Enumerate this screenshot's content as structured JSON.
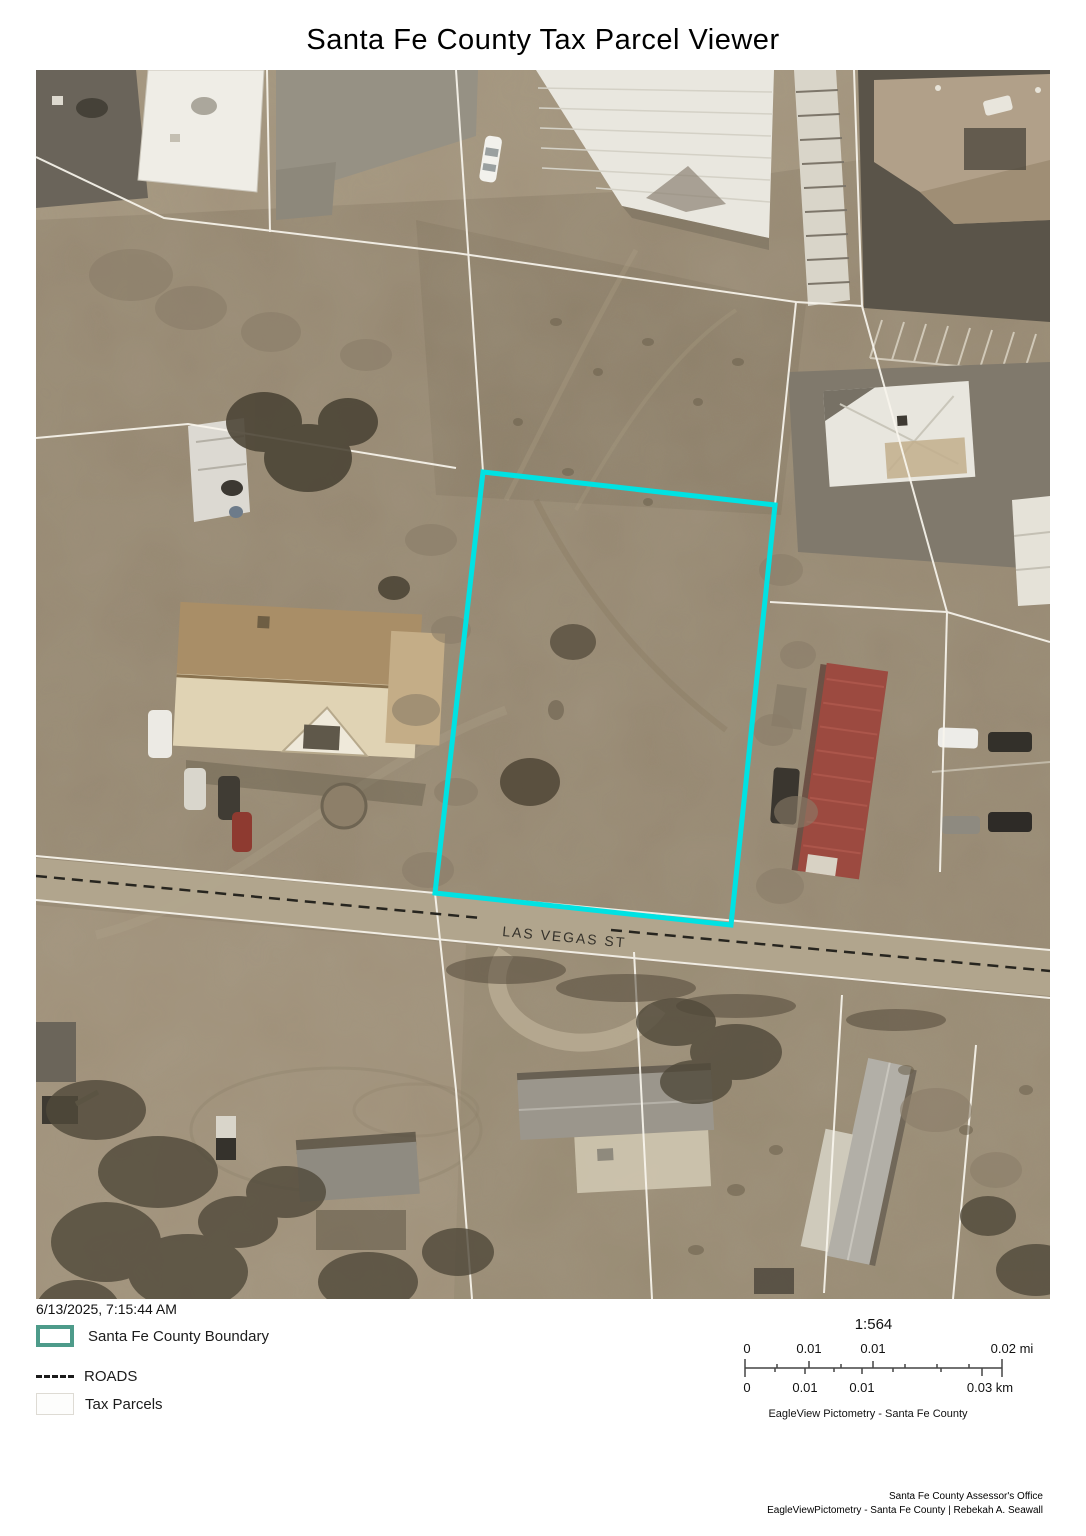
{
  "title": "Santa Fe County Tax Parcel Viewer",
  "map": {
    "road_label": "LAS VEGAS ST",
    "parcel_highlight_color": "#00E2E3"
  },
  "legend": {
    "timestamp": "6/13/2025, 7:15:44 AM",
    "items": [
      {
        "label": "Santa Fe County Boundary",
        "swatch_color": "#4D9B8A"
      },
      {
        "label": "ROADS",
        "swatch_style": "dashed-black"
      },
      {
        "label": "Tax Parcels",
        "swatch_color": "#DEDBD4"
      }
    ]
  },
  "scale": {
    "ratio": "1:564",
    "mi_labels": [
      "0",
      "0.01",
      "0.01",
      "0.02 mi"
    ],
    "km_labels": [
      "0",
      "0.01",
      "0.01",
      "0.03 km"
    ],
    "source": "EagleView Pictometry - Santa Fe County"
  },
  "credits": {
    "line1": "Santa Fe County Assessor's Office",
    "line2": "EagleViewPictometry - Santa Fe County | Rebekah A. Seawall"
  }
}
